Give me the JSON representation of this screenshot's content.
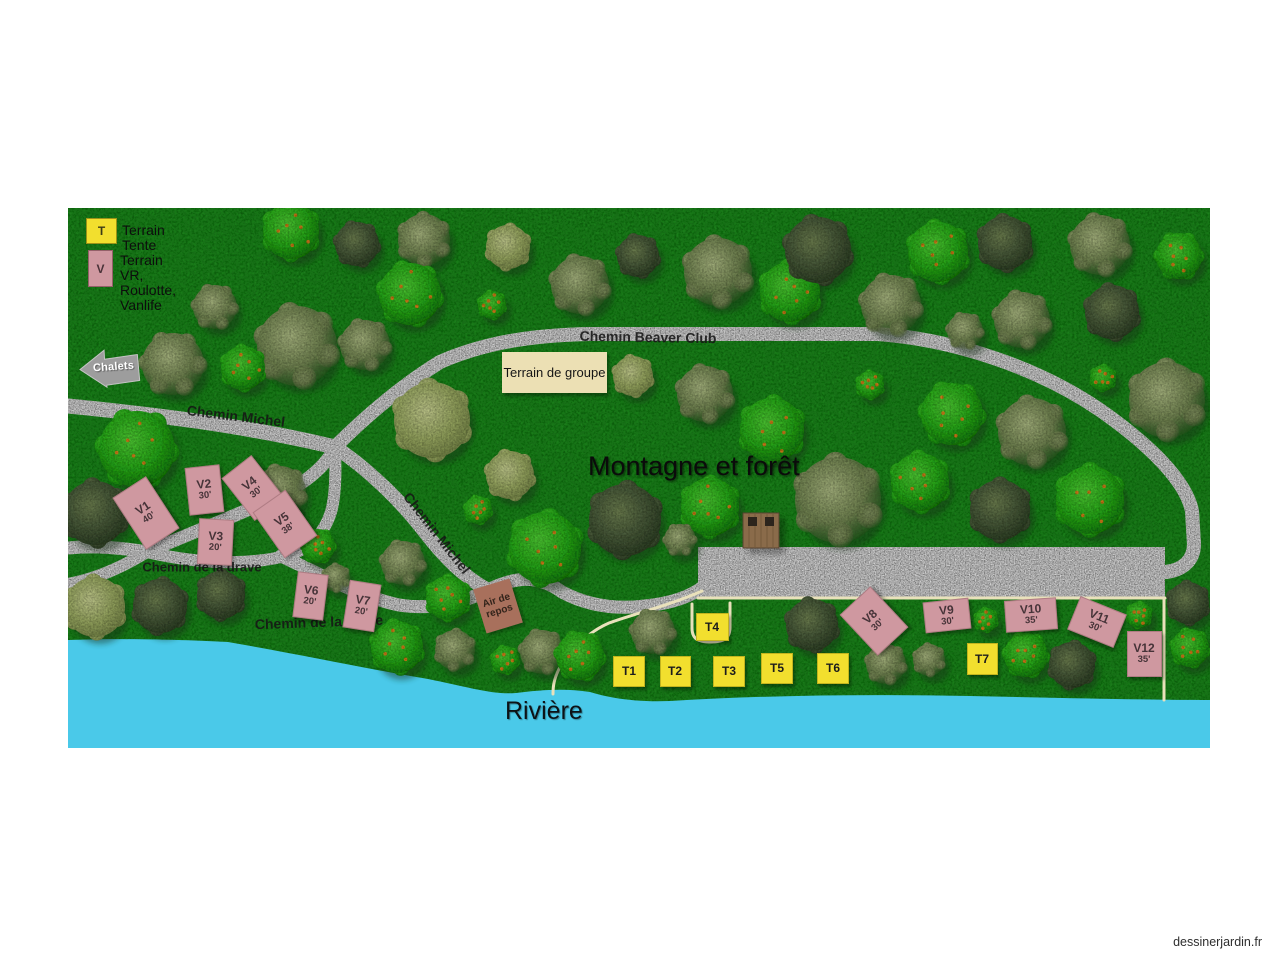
{
  "watermark": "dessinerjardin.fr",
  "colors": {
    "grass": "#1f7d1f",
    "gravel_path": "#d9d9d9",
    "parking": "#dadada",
    "thin_path": "#e9e1bb",
    "river": "#4ac9e9",
    "tent_site": "#f2df2e",
    "rv_site": "#cf98a0",
    "group_sign": "#ece0b4",
    "rest_sign": "#a8705c",
    "arrow_sign": "#9d9d9d"
  },
  "legend": {
    "tent_symbol": "T",
    "tent_label": "Terrain Tente",
    "rv_symbol": "V",
    "rv_label_line1": "Terrain VR, Roulotte,",
    "rv_label_line2": "Vanlife"
  },
  "signs": {
    "chalets": "Chalets",
    "group_area": "Terrain de groupe",
    "rest_area_line1": "Air de",
    "rest_area_line2": "repos"
  },
  "area_labels": {
    "mountain": "Montagne et forêt",
    "river": "Rivière"
  },
  "road_labels": [
    {
      "text": "Chemin Michel",
      "x": 168,
      "y": 208,
      "rot": 7,
      "size": 14
    },
    {
      "text": "Chemin Beaver Club",
      "x": 580,
      "y": 129,
      "rot": 1,
      "size": 14
    },
    {
      "text": "Chemin Michel",
      "x": 369,
      "y": 325,
      "rot": 52,
      "size": 14
    },
    {
      "text": "Chemin de la drave",
      "x": 134,
      "y": 359,
      "rot": 0,
      "size": 13
    },
    {
      "text": "Chemin de la drave",
      "x": 251,
      "y": 414,
      "rot": -2,
      "size": 14
    }
  ],
  "tent_sites": [
    {
      "id": "T1",
      "x": 560,
      "y": 462,
      "w": 30,
      "h": 29
    },
    {
      "id": "T2",
      "x": 606,
      "y": 462,
      "w": 29,
      "h": 29
    },
    {
      "id": "T3",
      "x": 660,
      "y": 462,
      "w": 30,
      "h": 29
    },
    {
      "id": "T4",
      "x": 643,
      "y": 418,
      "w": 31,
      "h": 26
    },
    {
      "id": "T5",
      "x": 708,
      "y": 459,
      "w": 30,
      "h": 29
    },
    {
      "id": "T6",
      "x": 764,
      "y": 459,
      "w": 30,
      "h": 29
    },
    {
      "id": "T7",
      "x": 913,
      "y": 450,
      "w": 29,
      "h": 30
    }
  ],
  "rv_sites": [
    {
      "id": "V1",
      "size": "40'",
      "x": 77,
      "y": 304,
      "w": 38,
      "h": 60,
      "rot": -33
    },
    {
      "id": "V2",
      "size": "30'",
      "x": 135,
      "y": 281,
      "w": 33,
      "h": 46,
      "rot": -6
    },
    {
      "id": "V3",
      "size": "20'",
      "x": 146,
      "y": 333,
      "w": 33,
      "h": 44,
      "rot": 3
    },
    {
      "id": "V4",
      "size": "30'",
      "x": 184,
      "y": 279,
      "w": 36,
      "h": 52,
      "rot": -38
    },
    {
      "id": "V5",
      "size": "38'",
      "x": 216,
      "y": 315,
      "w": 38,
      "h": 54,
      "rot": -35
    },
    {
      "id": "V6",
      "size": "20'",
      "x": 241,
      "y": 387,
      "w": 29,
      "h": 44,
      "rot": 7
    },
    {
      "id": "V7",
      "size": "20'",
      "x": 293,
      "y": 397,
      "w": 30,
      "h": 46,
      "rot": 9
    },
    {
      "id": "V8",
      "size": "30'",
      "x": 805,
      "y": 412,
      "w": 40,
      "h": 54,
      "rot": -43
    },
    {
      "id": "V9",
      "size": "30'",
      "x": 878,
      "y": 406,
      "w": 44,
      "h": 29,
      "rot": -6
    },
    {
      "id": "V10",
      "size": "35'",
      "x": 962,
      "y": 406,
      "w": 50,
      "h": 30,
      "rot": -4
    },
    {
      "id": "V11",
      "size": "30'",
      "x": 1028,
      "y": 413,
      "w": 48,
      "h": 34,
      "rot": 22
    },
    {
      "id": "V12",
      "size": "35'",
      "x": 1075,
      "y": 445,
      "w": 33,
      "h": 44,
      "rot": 0
    }
  ],
  "trees": [
    [
      147,
      99,
      22,
      "o"
    ],
    [
      223,
      23,
      28,
      "b"
    ],
    [
      229,
      138,
      40,
      "o"
    ],
    [
      105,
      156,
      31,
      "o"
    ],
    [
      175,
      160,
      22,
      "b"
    ],
    [
      289,
      36,
      22,
      "d"
    ],
    [
      356,
      32,
      26,
      "o"
    ],
    [
      342,
      86,
      31,
      "b"
    ],
    [
      440,
      39,
      22,
      "l"
    ],
    [
      424,
      97,
      14,
      "b"
    ],
    [
      512,
      77,
      29,
      "o"
    ],
    [
      570,
      48,
      21,
      "d"
    ],
    [
      650,
      64,
      34,
      "o"
    ],
    [
      722,
      84,
      30,
      "b"
    ],
    [
      750,
      42,
      33,
      "d"
    ],
    [
      823,
      97,
      30,
      "o"
    ],
    [
      870,
      44,
      30,
      "b"
    ],
    [
      937,
      35,
      27,
      "d"
    ],
    [
      1032,
      37,
      30,
      "o"
    ],
    [
      1111,
      48,
      23,
      "b"
    ],
    [
      897,
      123,
      18,
      "o"
    ],
    [
      954,
      112,
      28,
      "o"
    ],
    [
      1044,
      104,
      27,
      "d"
    ],
    [
      69,
      241,
      38,
      "b"
    ],
    [
      27,
      305,
      32,
      "d"
    ],
    [
      212,
      284,
      26,
      "o"
    ],
    [
      250,
      338,
      17,
      "b"
    ],
    [
      297,
      137,
      25,
      "o"
    ],
    [
      364,
      212,
      38,
      "l"
    ],
    [
      442,
      267,
      24,
      "l"
    ],
    [
      410,
      302,
      14,
      "b"
    ],
    [
      477,
      340,
      36,
      "b"
    ],
    [
      557,
      312,
      36,
      "d"
    ],
    [
      642,
      299,
      29,
      "b"
    ],
    [
      612,
      332,
      16,
      "o"
    ],
    [
      565,
      168,
      20,
      "l"
    ],
    [
      637,
      186,
      28,
      "o"
    ],
    [
      704,
      222,
      32,
      "b"
    ],
    [
      802,
      177,
      14,
      "b"
    ],
    [
      884,
      206,
      31,
      "b"
    ],
    [
      852,
      274,
      29,
      "b"
    ],
    [
      964,
      224,
      34,
      "o"
    ],
    [
      932,
      302,
      30,
      "d"
    ],
    [
      1022,
      292,
      34,
      "b"
    ],
    [
      770,
      292,
      43,
      "o"
    ],
    [
      1035,
      170,
      13,
      "b"
    ],
    [
      1099,
      192,
      38,
      "o"
    ],
    [
      27,
      399,
      30,
      "l"
    ],
    [
      92,
      398,
      27,
      "d"
    ],
    [
      153,
      387,
      24,
      "d"
    ],
    [
      268,
      370,
      14,
      "o"
    ],
    [
      335,
      355,
      22,
      "o"
    ],
    [
      380,
      390,
      22,
      "b"
    ],
    [
      329,
      439,
      26,
      "b"
    ],
    [
      387,
      442,
      20,
      "o"
    ],
    [
      437,
      452,
      14,
      "b"
    ],
    [
      474,
      444,
      22,
      "o"
    ],
    [
      512,
      448,
      24,
      "b"
    ],
    [
      585,
      424,
      22,
      "o"
    ],
    [
      744,
      417,
      26,
      "d"
    ],
    [
      818,
      456,
      20,
      "o"
    ],
    [
      861,
      452,
      16,
      "o"
    ],
    [
      918,
      412,
      12,
      "b"
    ],
    [
      958,
      447,
      22,
      "b"
    ],
    [
      1004,
      457,
      23,
      "d"
    ],
    [
      1071,
      407,
      13,
      "b"
    ],
    [
      1120,
      395,
      21,
      "d"
    ],
    [
      1122,
      440,
      19,
      "b"
    ]
  ]
}
